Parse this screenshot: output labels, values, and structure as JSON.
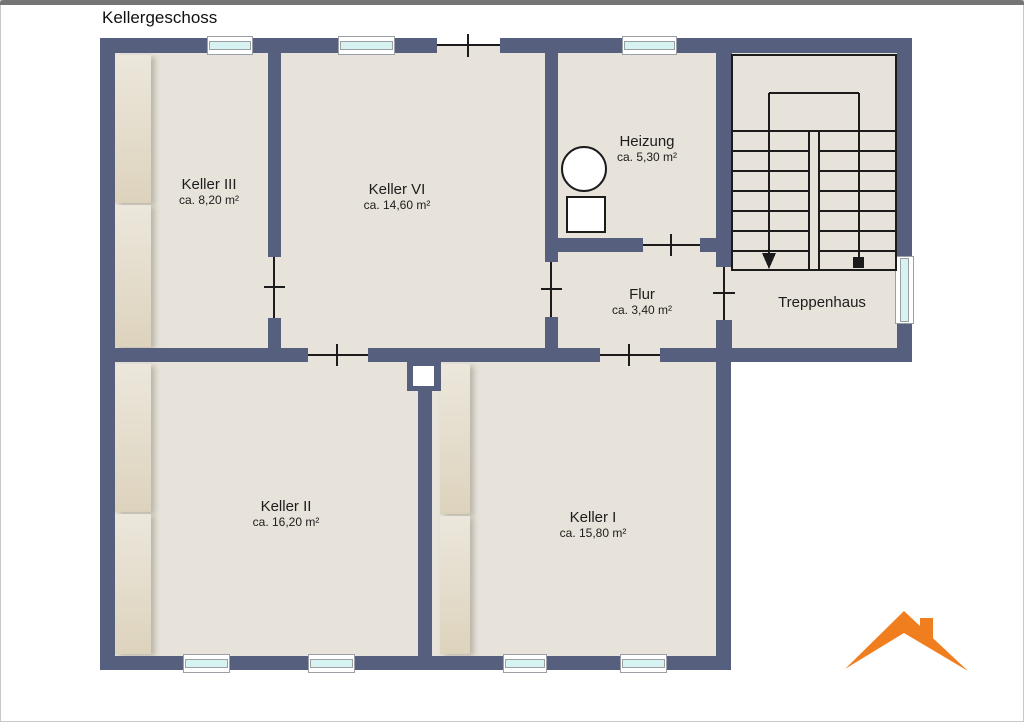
{
  "title": "Kellergeschoss",
  "rooms": {
    "keller3": {
      "name": "Keller III",
      "area": "ca. 8,20 m²"
    },
    "keller6": {
      "name": "Keller VI",
      "area": "ca. 14,60 m²"
    },
    "heizung": {
      "name": "Heizung",
      "area": "ca. 5,30 m²"
    },
    "flur": {
      "name": "Flur",
      "area": "ca. 3,40 m²"
    },
    "treppenhaus": {
      "name": "Treppenhaus"
    },
    "keller2": {
      "name": "Keller II",
      "area": "ca. 16,20 m²"
    },
    "keller1": {
      "name": "Keller I",
      "area": "ca. 15,80 m²"
    }
  },
  "icons": {
    "logo": "orange-roof-with-chimney-logo",
    "stairs_left_flight": "down-arrow-icon",
    "stairs_right_flight": "start-dot-icon",
    "heizung_boiler": "circle-boiler-symbol",
    "heizung_tank": "square-tank-symbol"
  },
  "colors": {
    "wall": "#565f7d",
    "floor": "#e7e3da",
    "window_glass": "#d7f3f1",
    "stair_line": "#1b1b1b",
    "logo_accent": "#f07e1f",
    "topbar": "#757575"
  }
}
